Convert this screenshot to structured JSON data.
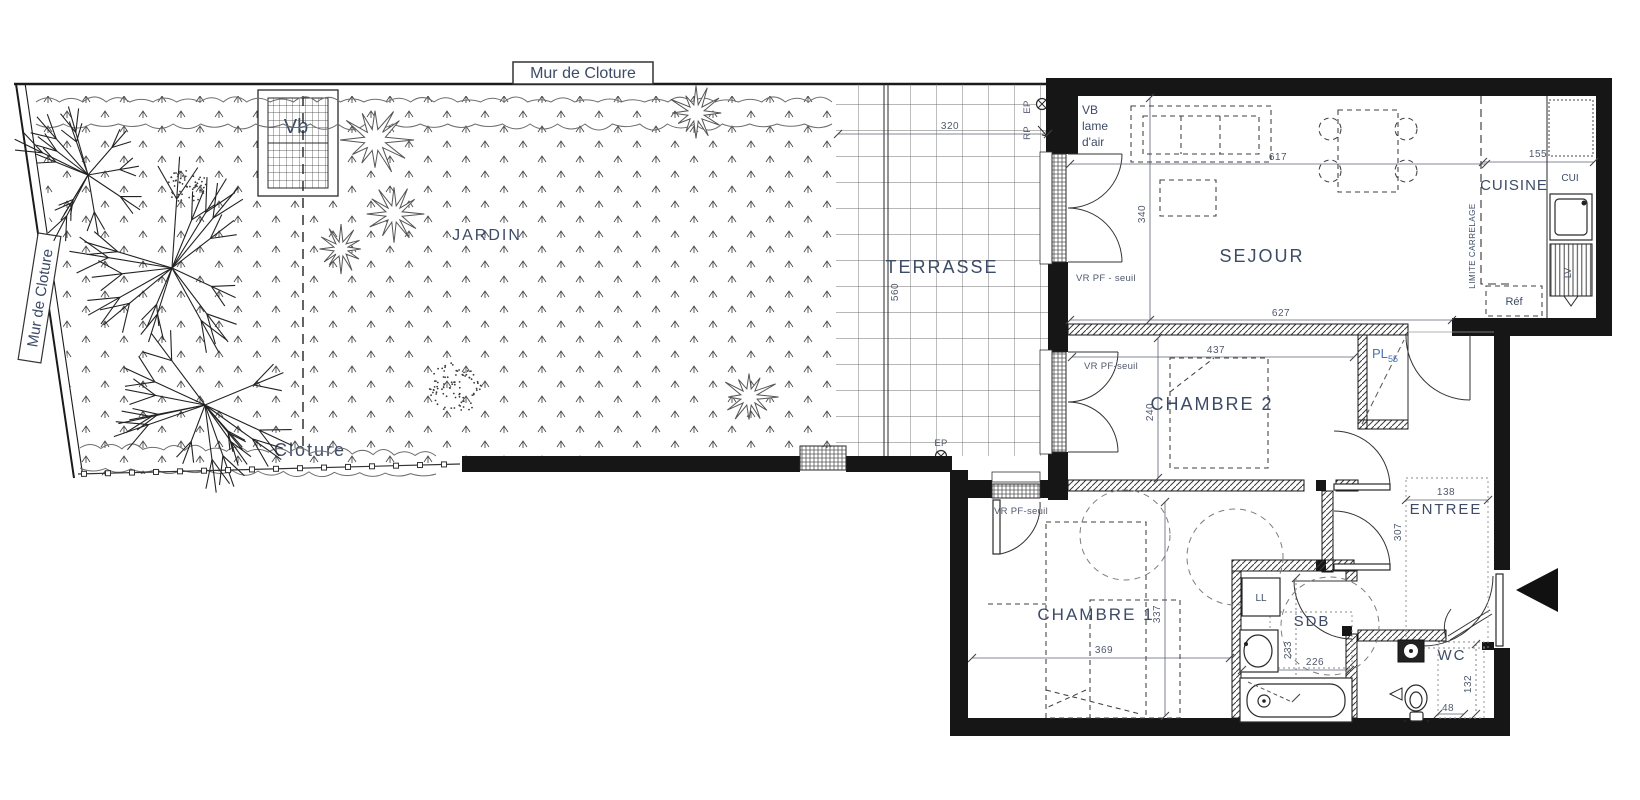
{
  "colors": {
    "text": "#3c4b66",
    "dim": "#4f586c",
    "line": "#1d1d1d",
    "accent": "#4a73b8"
  },
  "site": {
    "wall_top_label": "Mur de Cloture",
    "wall_left_label": "Mur de Cloture"
  },
  "garden": {
    "label": "JARDIN",
    "fence_label": "Cloture",
    "planter_label": "Vb"
  },
  "terrace": {
    "label": "TERRASSE",
    "dim_width": "320",
    "dim_depth": "560",
    "drain_top": "EP",
    "rain_top": "RP",
    "drain_bottom": "EP"
  },
  "sejour": {
    "label": "SEJOUR",
    "dim_top": "617",
    "dim_bottom": "627",
    "dim_side": "340",
    "vent_line1": "VB",
    "vent_line2": "lame",
    "vent_line3": "d'air",
    "window_note": "VR  PF - seuil"
  },
  "cuisine": {
    "label": "CUISINE",
    "dim": "155",
    "unit": "CUI",
    "dishwasher": "LV",
    "fridge": "Réf",
    "tile_limit": "LIMITE CARRELAGE"
  },
  "chambre2": {
    "label": "CHAMBRE 2",
    "dim_top": "437",
    "dim_side": "240",
    "window_note": "VR PF-seuil",
    "closet": "PL",
    "closet_dim": "55"
  },
  "entree": {
    "label": "ENTREE",
    "dim_width": "138",
    "dim_depth": "307"
  },
  "chambre1": {
    "label": "CHAMBRE 1",
    "dim_width": "369",
    "dim_side": "337",
    "window_note": "VR PF-seuil"
  },
  "sdb": {
    "label": "SDB",
    "dim_side": "233",
    "dim_width": "226",
    "washer": "LL"
  },
  "wc": {
    "label": "WC",
    "dim_side": "132",
    "dim_width": "48"
  }
}
